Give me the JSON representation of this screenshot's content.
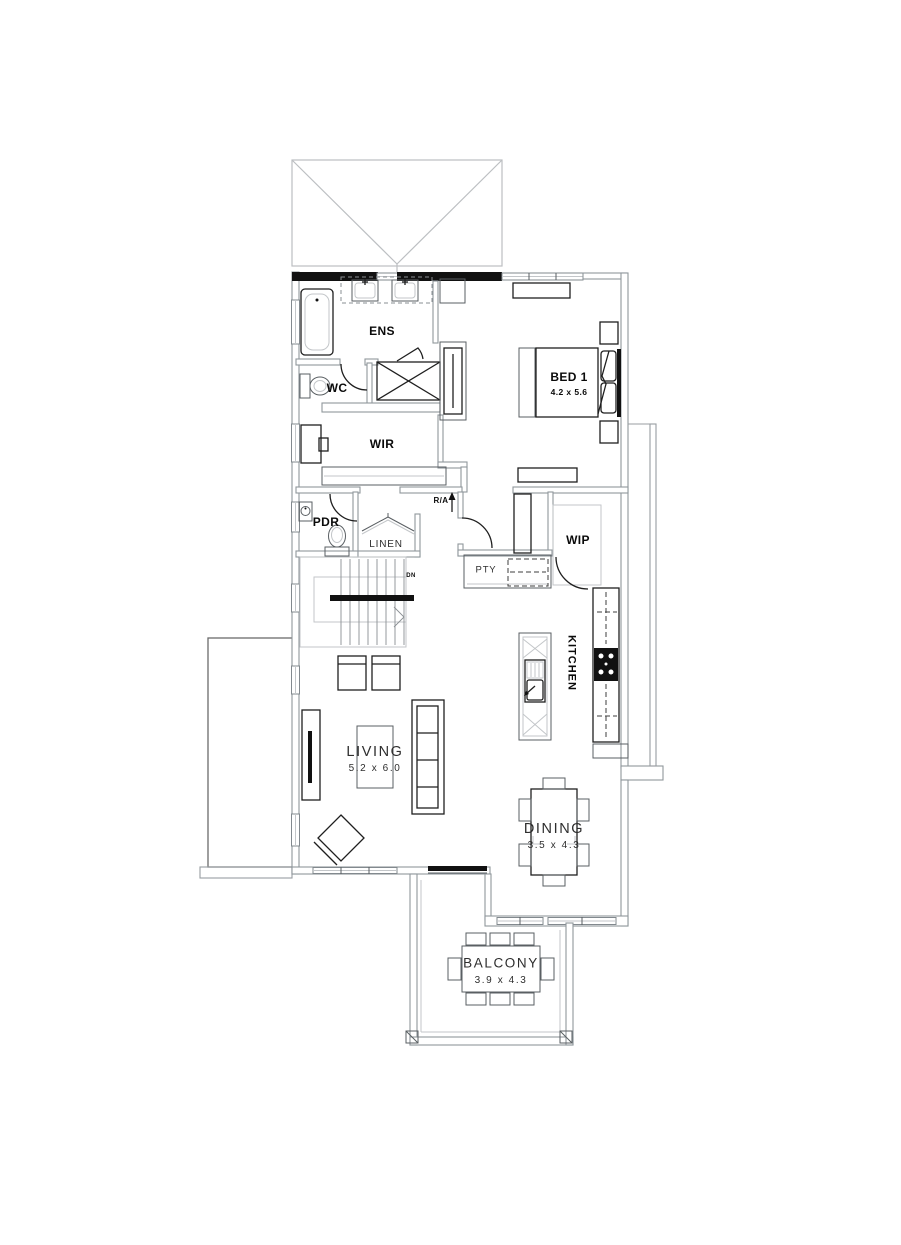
{
  "plan": {
    "type": "residential-floor-plan-upper-level",
    "labels": {
      "ens": "ENS",
      "wc": "WC",
      "bed1": "BED 1",
      "bed1_dims": "4.2 x 5.6",
      "wir": "WIR",
      "pdr": "PDR",
      "linen": "LINEN",
      "return_air": "R/A",
      "wip": "WIP",
      "pantry": "PTY",
      "kitchen": "KITCHEN",
      "stair_direction": "DN",
      "living": "LIVING",
      "living_dims": "5.2 x 6.0",
      "dining": "DINING",
      "dining_dims": "3.5 x 4.3",
      "balcony": "BALCONY",
      "balcony_dims": "3.9 x 4.3"
    },
    "colors": {
      "wall_dark": "#111111",
      "wall_line": "#8f979c",
      "roof_line": "#bcbfc2",
      "label_bold": "#0a0a0a",
      "label_light": "#2e2e2e"
    }
  }
}
